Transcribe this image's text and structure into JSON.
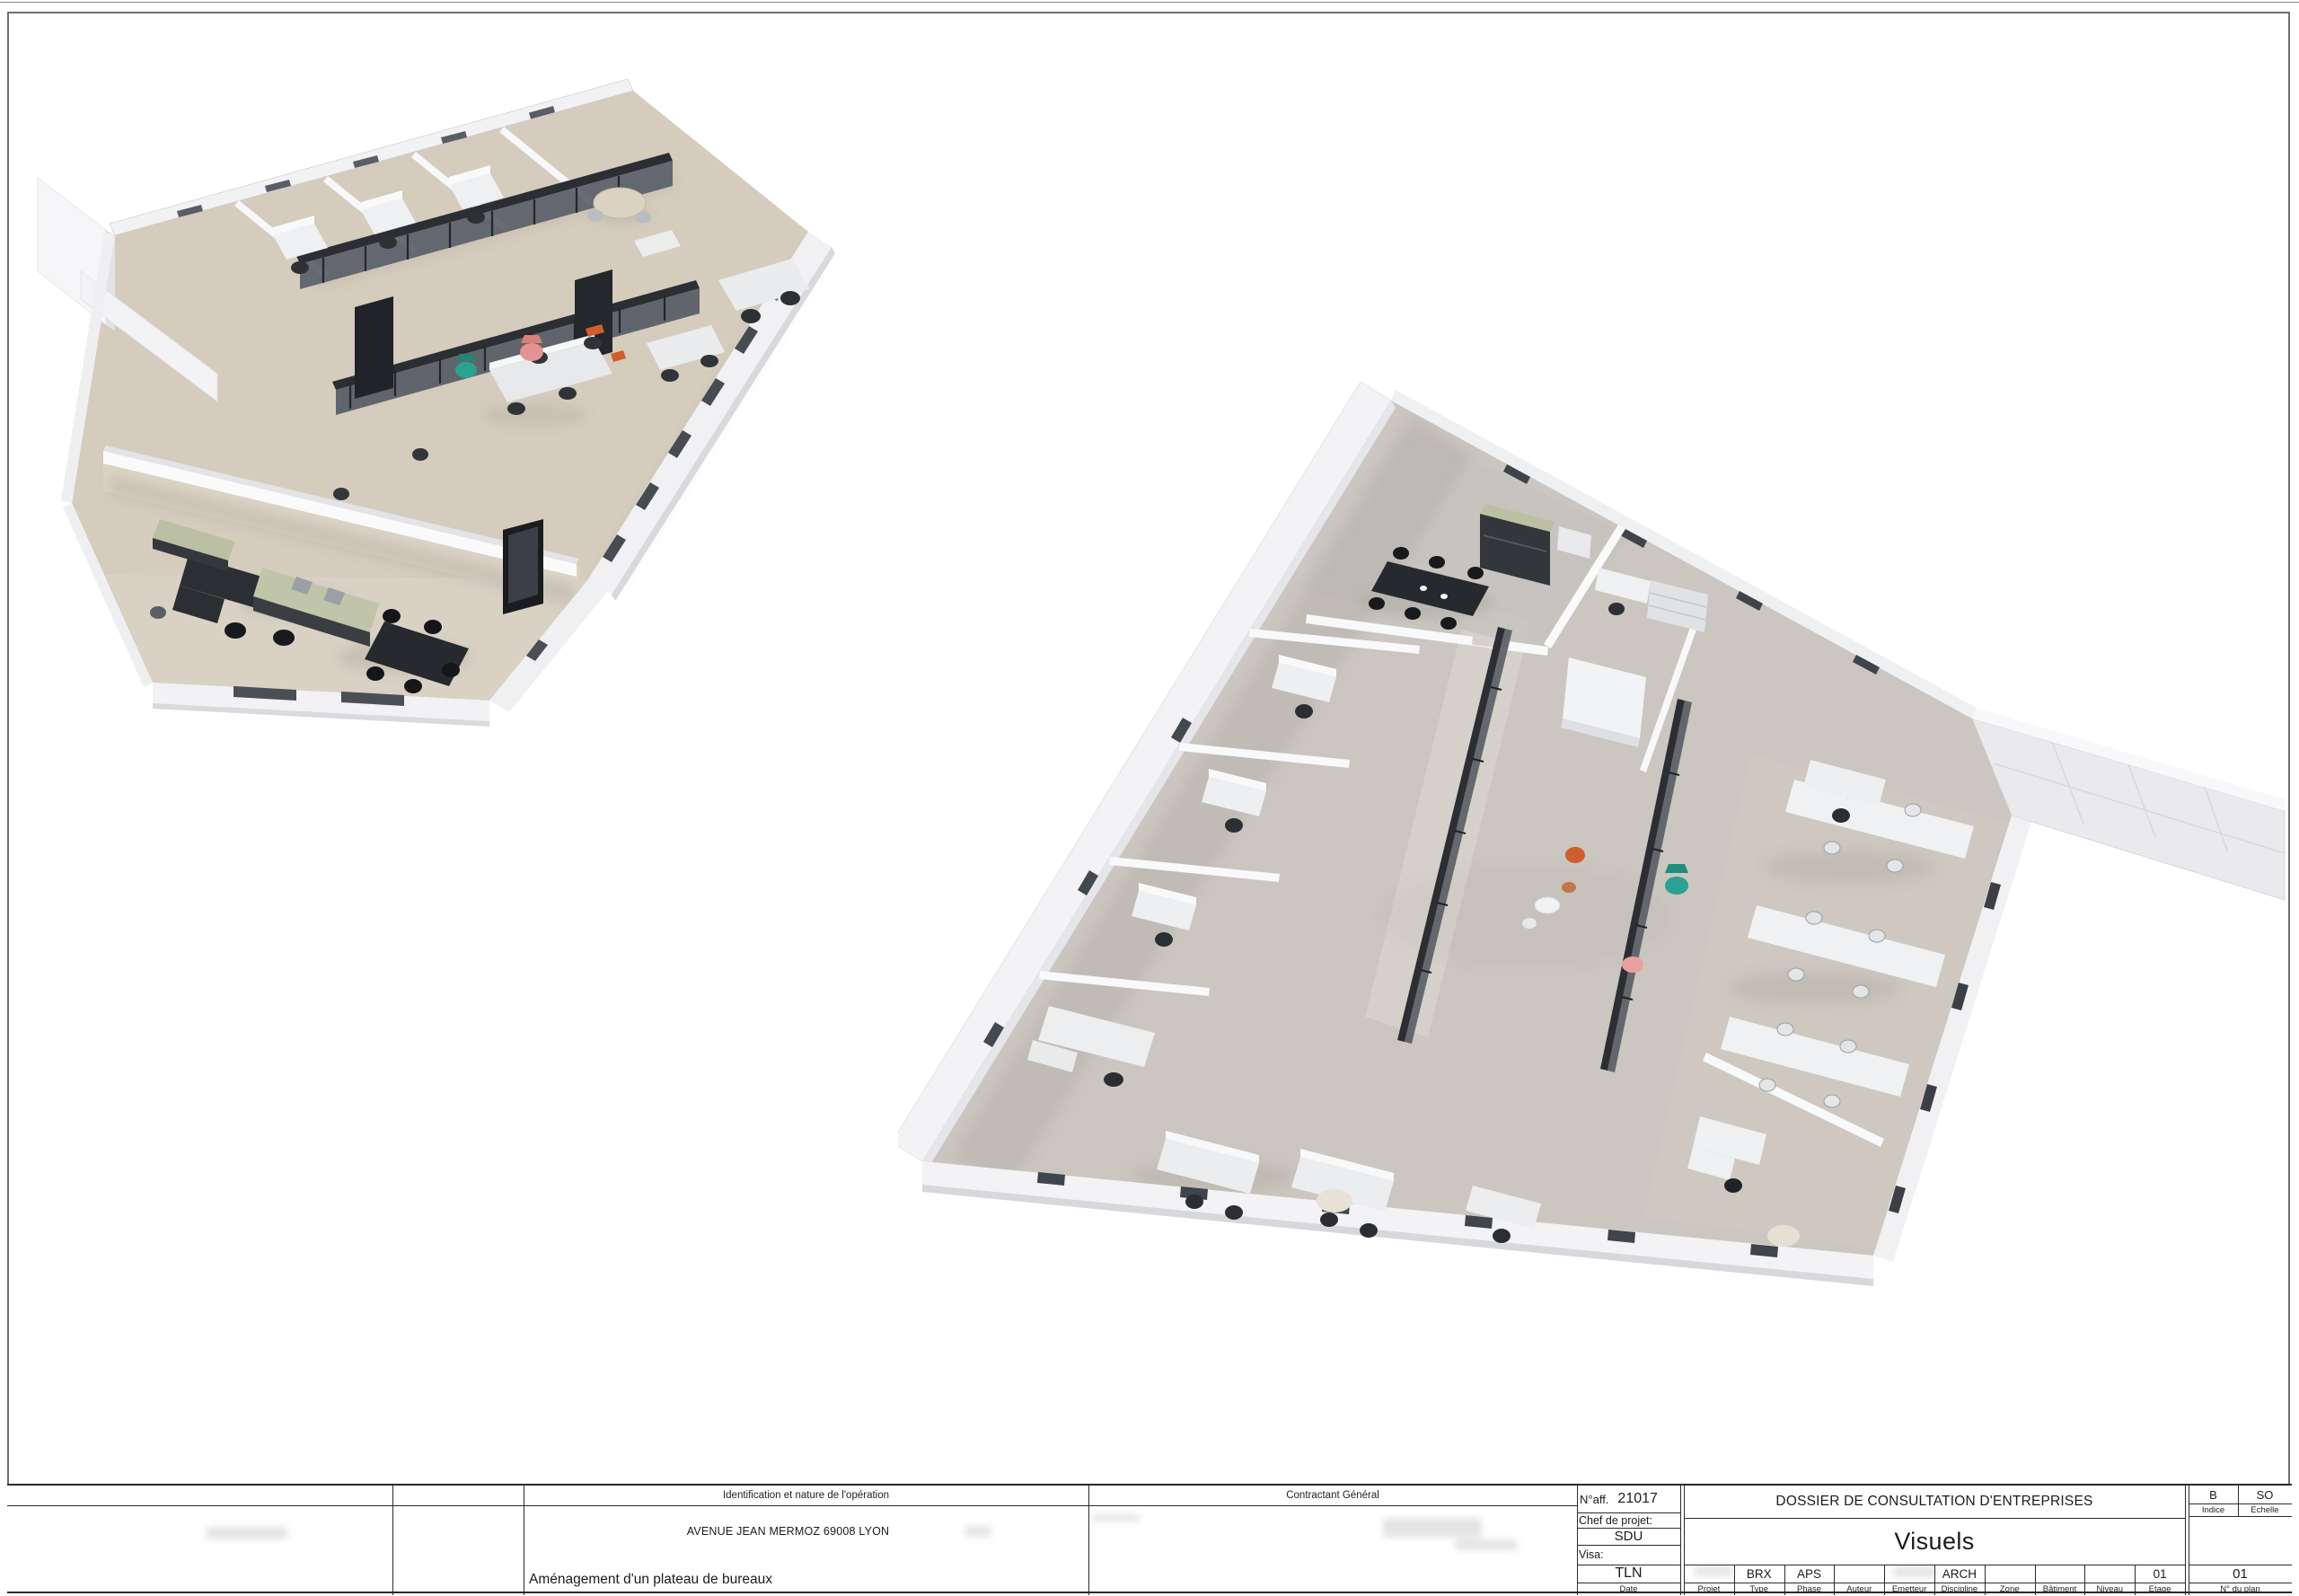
{
  "sheet": {
    "background": "#ffffff",
    "border_color": "#6f6f6f"
  },
  "palette": {
    "floor_render1": "#d5ccbe",
    "floor_render2": "#cbc6bf",
    "wall_white": "#f3f3f6",
    "glass_dark": "#2b2e33",
    "accent_coral": "#e59391",
    "accent_teal": "#2aa191",
    "accent_orange": "#cd5f2e",
    "accent_sage": "#bcc0a3"
  },
  "title_block": {
    "identification": {
      "header": "Identification et nature de l'opération",
      "address": "AVENUE JEAN MERMOZ 69008 LYON",
      "operation": "Aménagement d'un plateau de bureaux"
    },
    "contractant": {
      "header": "Contractant Général"
    },
    "project": {
      "naff_label": "N°aff.",
      "naff_value": "21017",
      "chef_label": "Chef de projet:",
      "chef_value": "SDU",
      "visa_label": "Visa:",
      "visa_value": "TLN",
      "date_label": "Date"
    },
    "dossier": {
      "title": "DOSSIER DE CONSULTATION D'ENTREPRISES",
      "subtitle": "Visuels"
    },
    "meta": {
      "columns": [
        {
          "label": "Projet",
          "value": ""
        },
        {
          "label": "Type",
          "value": "BRX"
        },
        {
          "label": "Phase",
          "value": "APS"
        },
        {
          "label": "Auteur",
          "value": ""
        },
        {
          "label": "Emetteur",
          "value": ""
        },
        {
          "label": "Discipline",
          "value": "ARCH"
        },
        {
          "label": "Zone",
          "value": ""
        },
        {
          "label": "Bâtiment",
          "value": ""
        },
        {
          "label": "Niveau",
          "value": ""
        },
        {
          "label": "Etage",
          "value": "01"
        }
      ]
    },
    "indice": {
      "label": "Indice",
      "value": "B"
    },
    "echelle": {
      "label": "Echelle",
      "value": "SO"
    },
    "plan": {
      "label": "N° du plan",
      "value": "01"
    }
  }
}
